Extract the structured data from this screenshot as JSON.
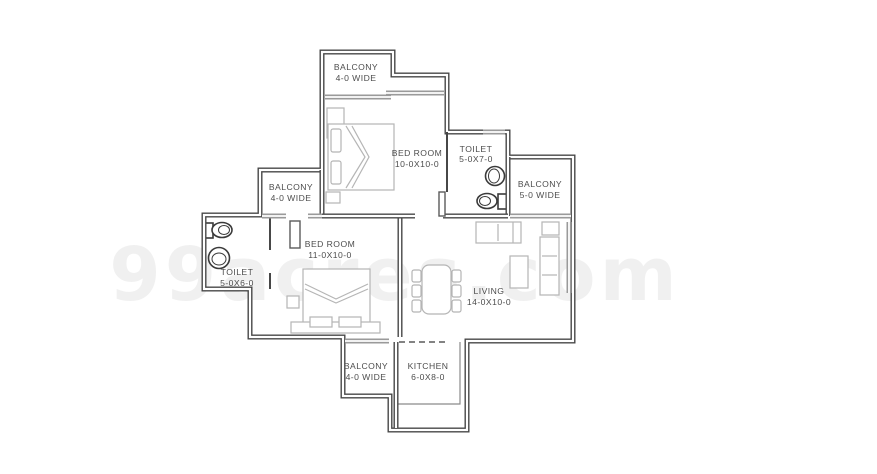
{
  "watermark": "99acres.com",
  "rooms": {
    "balcony_top": {
      "name": "BALCONY",
      "size": "4-0 WIDE"
    },
    "bedroom_1": {
      "name": "BED ROOM",
      "size": "10-0X10-0"
    },
    "toilet_1": {
      "name": "TOILET",
      "size": "5-0X7-0"
    },
    "balcony_right": {
      "name": "BALCONY",
      "size": "5-0 WIDE"
    },
    "balcony_left": {
      "name": "BALCONY",
      "size": "4-0 WIDE"
    },
    "toilet_2": {
      "name": "TOILET",
      "size": "5-0X6-0"
    },
    "bedroom_2": {
      "name": "BED ROOM",
      "size": "11-0X10-0"
    },
    "living": {
      "name": "LIVING",
      "size": "14-0X10-0"
    },
    "balcony_bottom": {
      "name": "BALCONY",
      "size": "4-0 WIDE"
    },
    "kitchen": {
      "name": "KITCHEN",
      "size": "6-0X8-0"
    }
  },
  "colors": {
    "wall": "#474747",
    "window": "#9a9a9a",
    "furniture": "#b5b5b5",
    "fixture": "#3a3a3a",
    "label": "#4d4d4d",
    "background": "#ffffff"
  }
}
